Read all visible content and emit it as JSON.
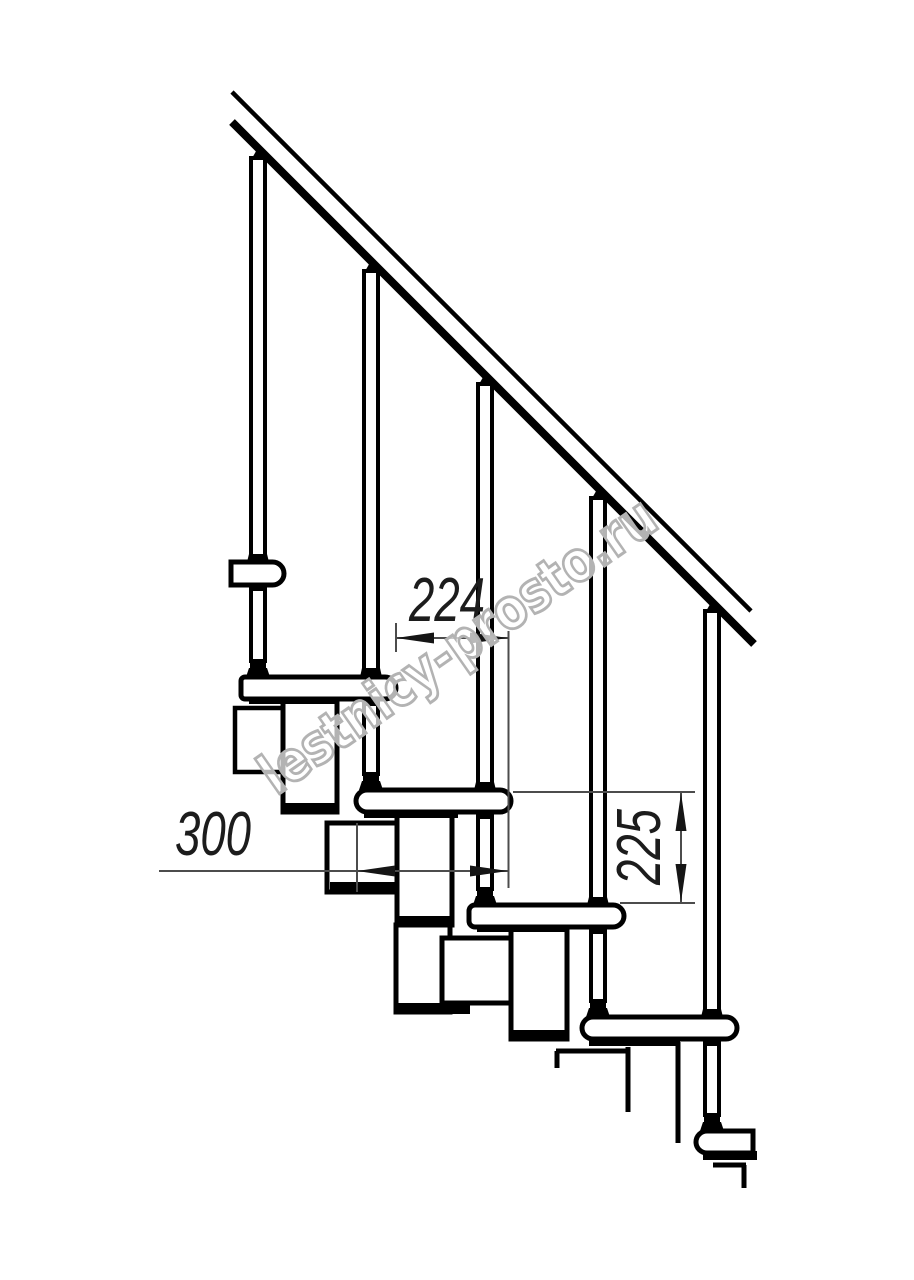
{
  "drawing": {
    "title": "staircase-side-view-fragment",
    "background_color": "#ffffff",
    "line_color": "#000000",
    "dimension_line_color": "#4c4c4c",
    "dimension_text_color": "#1c1c1c",
    "dimensions": [
      {
        "id": "step-run",
        "value": "224",
        "orientation": "horizontal"
      },
      {
        "id": "tread-depth",
        "value": "300",
        "orientation": "horizontal"
      },
      {
        "id": "riser-height",
        "value": "225",
        "orientation": "vertical"
      }
    ],
    "watermark": {
      "text": "lestnicy-prosto.ru",
      "color": "#b3b3b3"
    }
  }
}
